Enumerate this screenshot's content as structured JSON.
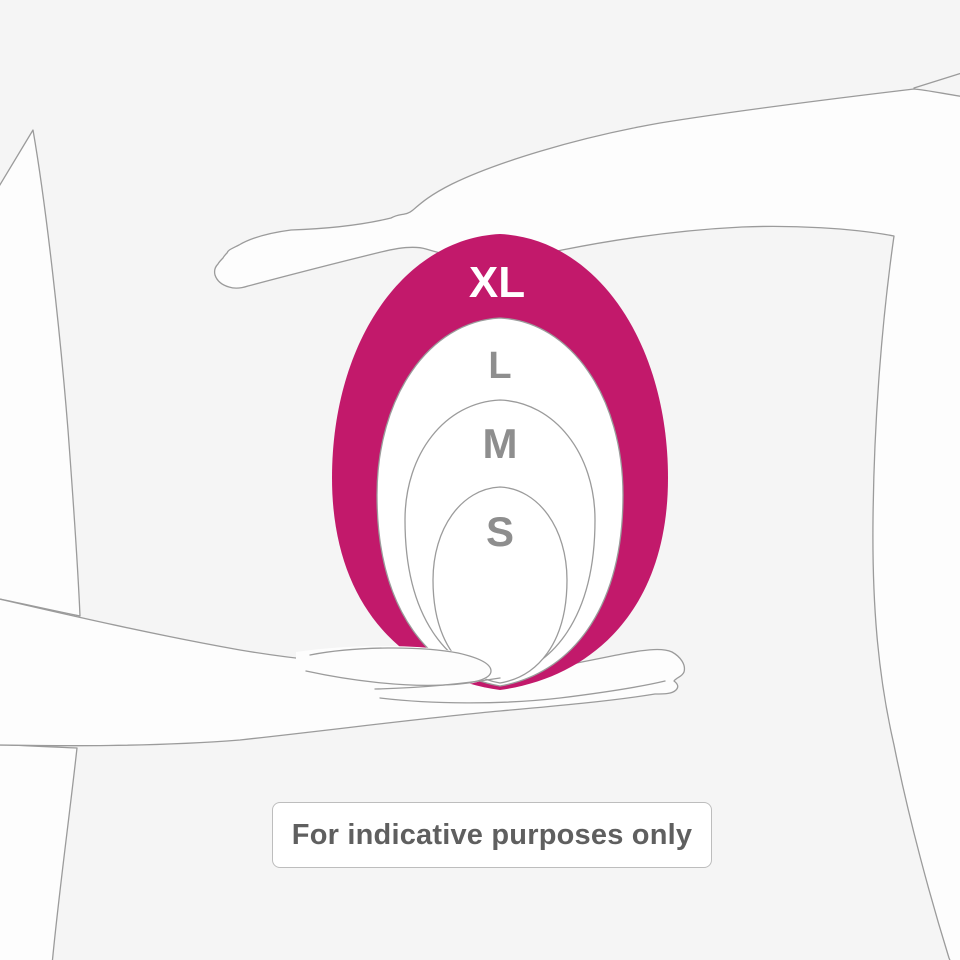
{
  "illustration": {
    "title": "product size comparison held between two hands",
    "caption": "For indicative purposes only",
    "background_color": "#f5f5f5",
    "outline_color": "#9b9b9b",
    "body_fill": "#fdfdfd",
    "accent_color": "#c2196b",
    "label_gray": "#8e8e8e",
    "caption_color": "#5f5f5f"
  },
  "sizes": [
    {
      "label": "XL",
      "fill": "#c2196b",
      "stroke": "none",
      "label_color": "#ffffff",
      "font_size": 44,
      "cx": 500,
      "top": 234,
      "bottom": 690,
      "rx": 168,
      "widest_y": 478,
      "label_x": 497,
      "label_y": 297
    },
    {
      "label": "L",
      "fill": "#ffffff",
      "stroke": "#9b9b9b",
      "label_color": "#8e8e8e",
      "font_size": 38,
      "cx": 500,
      "top": 318,
      "bottom": 686,
      "rx": 123,
      "widest_y": 495,
      "label_x": 500,
      "label_y": 378
    },
    {
      "label": "M",
      "fill": "#ffffff",
      "stroke": "#9b9b9b",
      "label_color": "#8e8e8e",
      "font_size": 42,
      "cx": 500,
      "top": 400,
      "bottom": 678,
      "rx": 95,
      "widest_y": 520,
      "label_x": 500,
      "label_y": 458
    },
    {
      "label": "S",
      "fill": "#ffffff",
      "stroke": "#9b9b9b",
      "label_color": "#8e8e8e",
      "font_size": 42,
      "cx": 500,
      "top": 487,
      "bottom": 683,
      "rx": 67,
      "widest_y": 580,
      "label_x": 500,
      "label_y": 546
    }
  ]
}
